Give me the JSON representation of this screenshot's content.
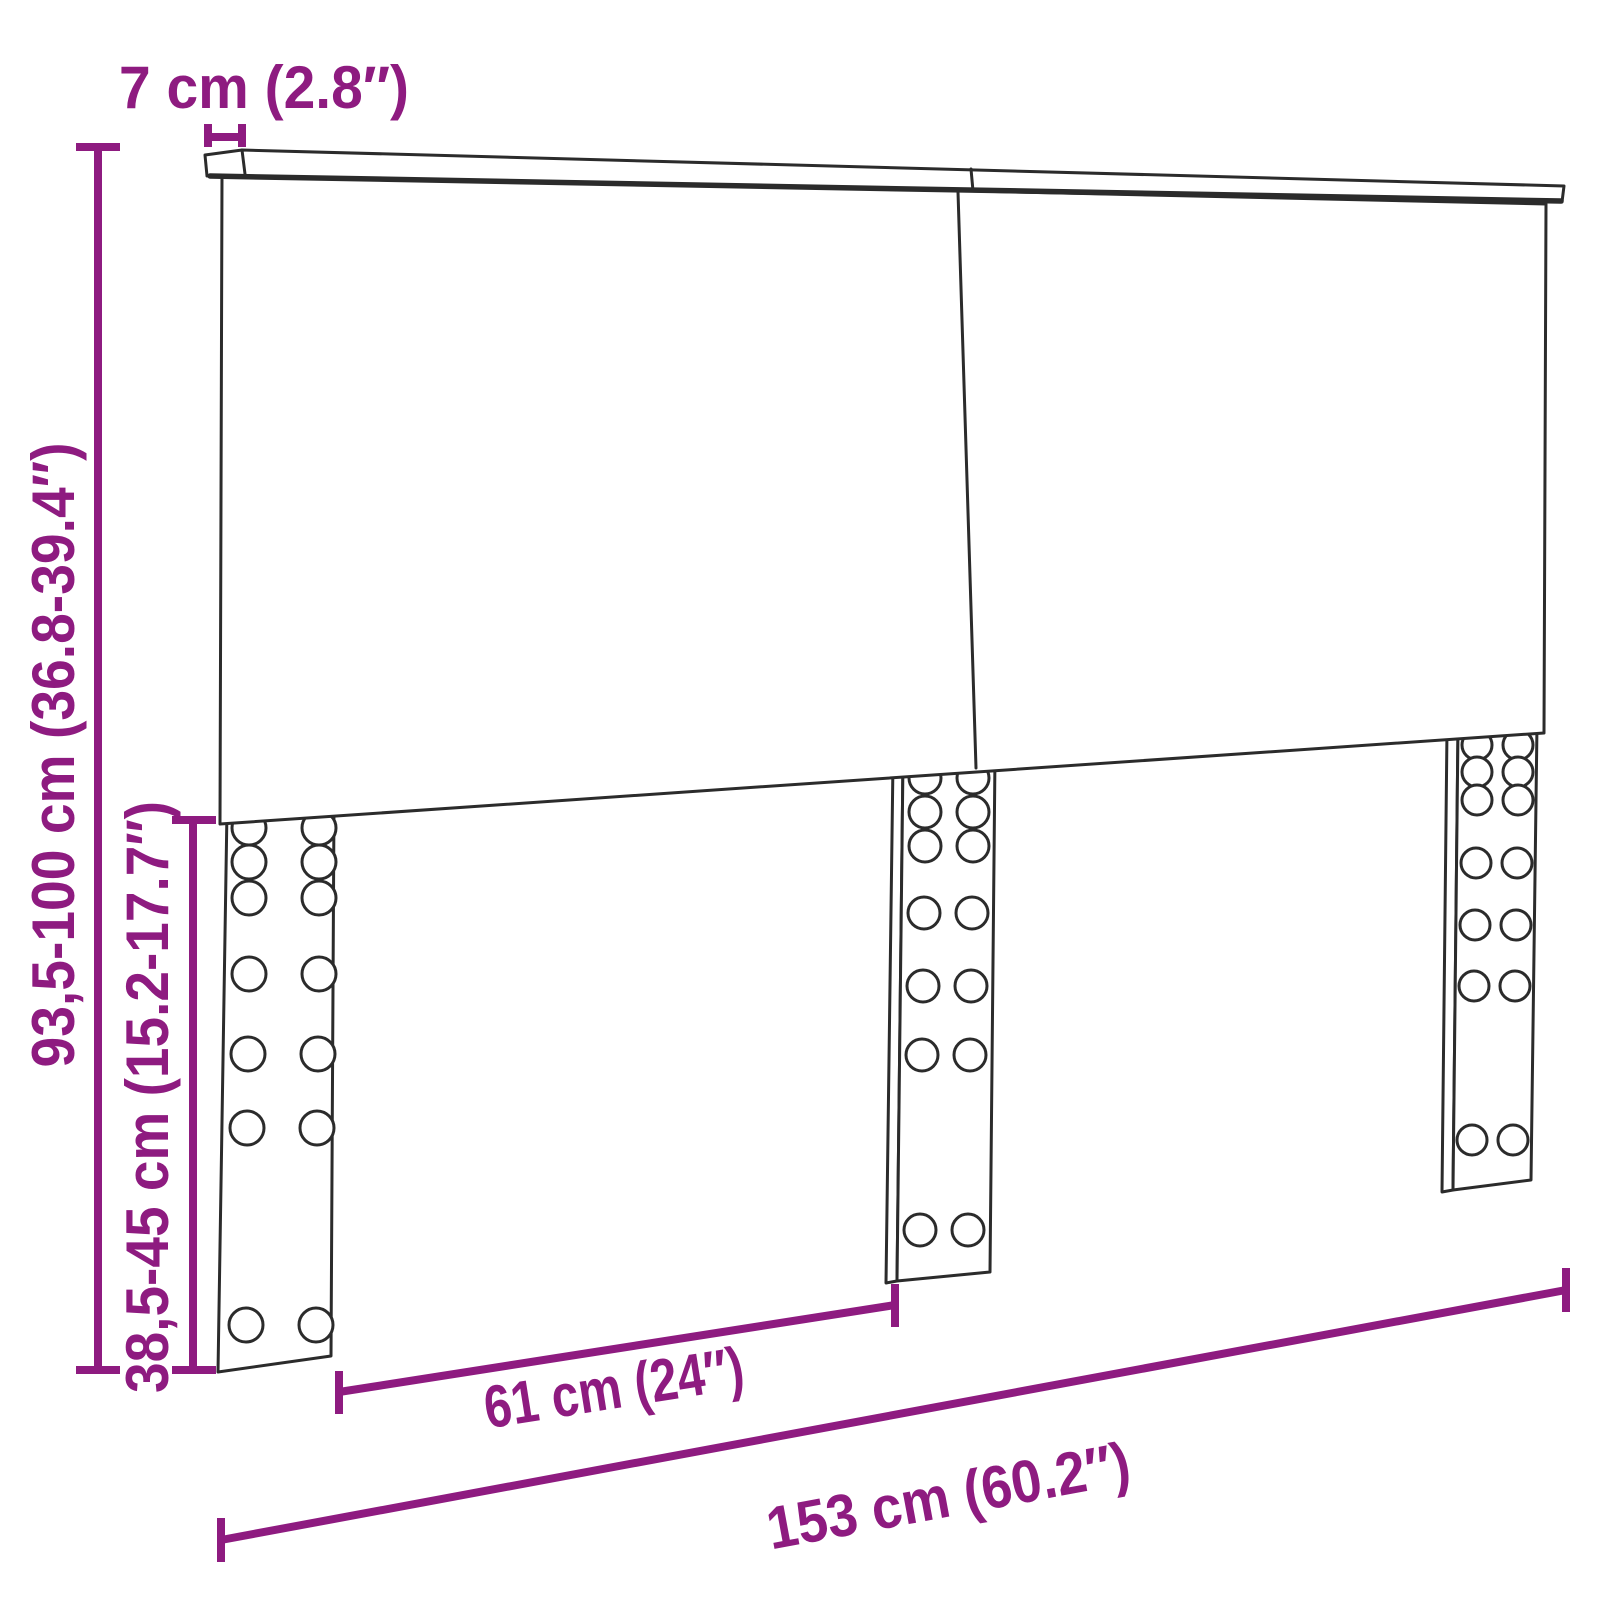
{
  "figure": {
    "colors": {
      "accent": "#8E1B80",
      "line": "#2B2B2B",
      "background": "#FFFFFF"
    },
    "dimensions": {
      "top_thickness": "7 cm (2.8″)",
      "total_height": "93,5-100 cm (36.8-39.4″)",
      "leg_height": "38,5-45 cm (15.2-17.7″)",
      "leg_spacing": "61 cm (24″)",
      "total_width": "153 cm (60.2″)"
    }
  }
}
